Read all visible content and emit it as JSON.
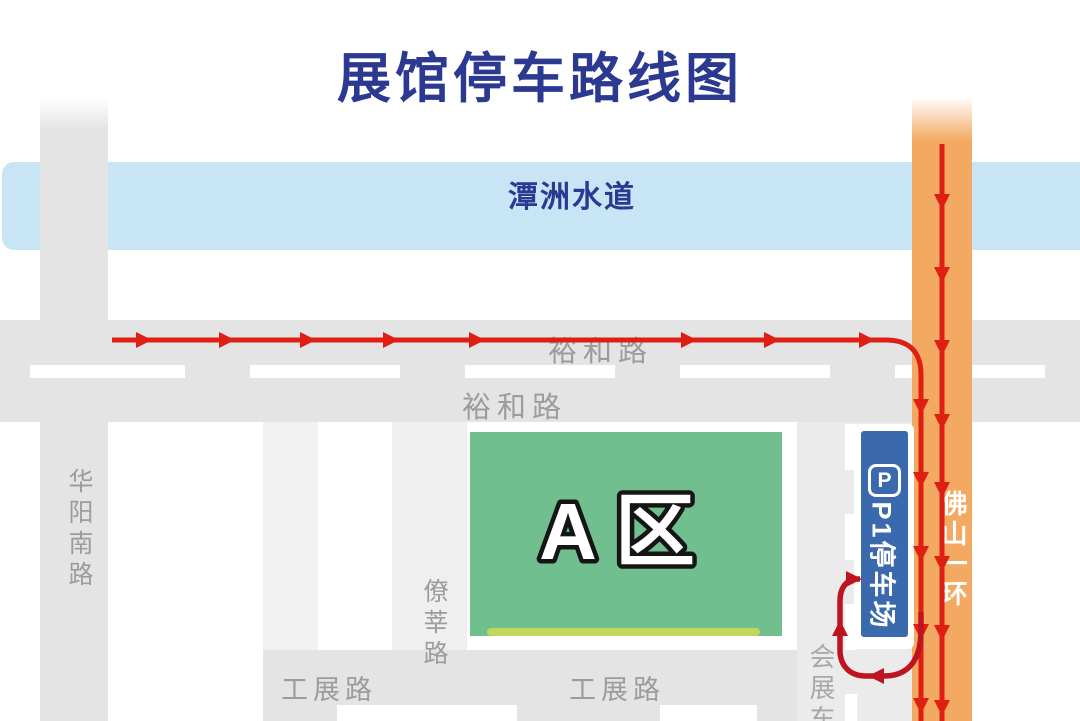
{
  "title": "展馆停车路线图",
  "colors": {
    "title_blue": "#2B3990",
    "waterway_fill": "#C8E5F6",
    "road_gray": "#E4E4E4",
    "road_light": "#EFEFEF",
    "road_lighter": "#F1F1F1",
    "huizhan_gray": "#EBEBEB",
    "orange_road": "#F3A962",
    "route_red": "#DF1F14",
    "route_dark_red": "#BE1420",
    "green_area": "#71BE8F",
    "lime_strip": "#BFD75B",
    "badge_blue": "#3A69AD",
    "label_gray": "#9C9C9C"
  },
  "waterway": {
    "label": "潭洲水道"
  },
  "roads": {
    "huayang_south": {
      "label": "华阳南路"
    },
    "yuhe_upper": {
      "label": "裕和路"
    },
    "yuhe_lower": {
      "label": "裕和路"
    },
    "liaoxin": {
      "label": "僚莘路"
    },
    "gongzhan_west": {
      "label": "工展路"
    },
    "gongzhan_east": {
      "label": "工展路"
    },
    "huizhan_east": {
      "label": "会展东"
    },
    "foshan_ring": {
      "label": "佛山一环"
    }
  },
  "area_a": {
    "label": "A区"
  },
  "parking": {
    "icon_letter": "P",
    "label": "P1停车场"
  },
  "routes": [
    {
      "id": "route-yuhe-to-ring",
      "color": "#DF1F14",
      "width": 5,
      "path": "M 112 340 L 886 340 Q 921 340 921 375 L 921 721",
      "arrows": [
        {
          "x": 152,
          "y": 340,
          "d": "right"
        },
        {
          "x": 235,
          "y": 340,
          "d": "right"
        },
        {
          "x": 316,
          "y": 340,
          "d": "right"
        },
        {
          "x": 399,
          "y": 340,
          "d": "right"
        },
        {
          "x": 485,
          "y": 340,
          "d": "right"
        },
        {
          "x": 697,
          "y": 340,
          "d": "right"
        },
        {
          "x": 780,
          "y": 340,
          "d": "right"
        },
        {
          "x": 875,
          "y": 340,
          "d": "right"
        },
        {
          "x": 921,
          "y": 415,
          "d": "down"
        },
        {
          "x": 921,
          "y": 488,
          "d": "down"
        },
        {
          "x": 921,
          "y": 562,
          "d": "down"
        },
        {
          "x": 921,
          "y": 640,
          "d": "down"
        },
        {
          "x": 921,
          "y": 714,
          "d": "down"
        }
      ]
    },
    {
      "id": "route-foshan-ring",
      "color": "#DF1F14",
      "width": 5,
      "path": "M 942 144 L 942 721",
      "arrows": [
        {
          "x": 942,
          "y": 210,
          "d": "down"
        },
        {
          "x": 942,
          "y": 283,
          "d": "down"
        },
        {
          "x": 942,
          "y": 356,
          "d": "down"
        },
        {
          "x": 942,
          "y": 430,
          "d": "down"
        },
        {
          "x": 942,
          "y": 498,
          "d": "down"
        },
        {
          "x": 942,
          "y": 572,
          "d": "down"
        },
        {
          "x": 942,
          "y": 641,
          "d": "down"
        },
        {
          "x": 942,
          "y": 716,
          "d": "down"
        }
      ]
    },
    {
      "id": "route-parking-branch",
      "color": "#BE1420",
      "width": 5.5,
      "path": "M 921 612 L 921 630 C 921 663 906 676 884 676 L 866 676 C 849 676 840 665 840 650 L 840 601 C 840 586 848 579 858 579 L 860 579",
      "arrows": [
        {
          "x": 868,
          "y": 676,
          "d": "left"
        },
        {
          "x": 840,
          "y": 620,
          "d": "up"
        },
        {
          "x": 862,
          "y": 579,
          "d": "right"
        }
      ]
    }
  ]
}
